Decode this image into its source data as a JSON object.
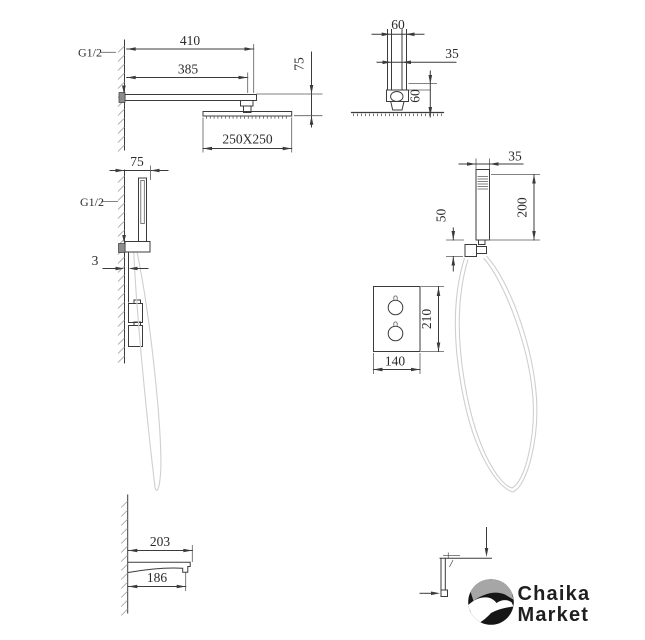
{
  "document": {
    "type": "shower-system-technical-drawing",
    "background": "#ffffff"
  },
  "colors": {
    "line": "#3b3b3b",
    "dimension_text": "#2b2b2b",
    "hose": "#cfcfcf",
    "hatch": "#9c9c9c",
    "fitting_fill": "#8c8c8c",
    "logo_circle": "#161616",
    "logo_sky": "#a6a6a6",
    "logo_bird": "#ffffff",
    "logo_text": "#1f1f1f"
  },
  "views": {
    "overhead_side": {
      "g_thread": "G1/2",
      "arm_length": "410",
      "arm_reach": "385",
      "head_drop": "75",
      "head_size": "250X250"
    },
    "overhead_front": {
      "flange_width": "60",
      "pipe_width": "35",
      "drop": "60"
    },
    "handshower_side": {
      "bracket_span": "75",
      "g_thread": "G1/2",
      "plate_gap": "3"
    },
    "handshower_front": {
      "wand_width": "35",
      "outlet_drop": "50",
      "wand_length": "200",
      "plate_height": "210",
      "plate_width": "140"
    },
    "spout_side": {
      "total_length": "203",
      "body_length": "186"
    }
  },
  "logo": {
    "line1": "Chaika",
    "line2": "Market"
  }
}
